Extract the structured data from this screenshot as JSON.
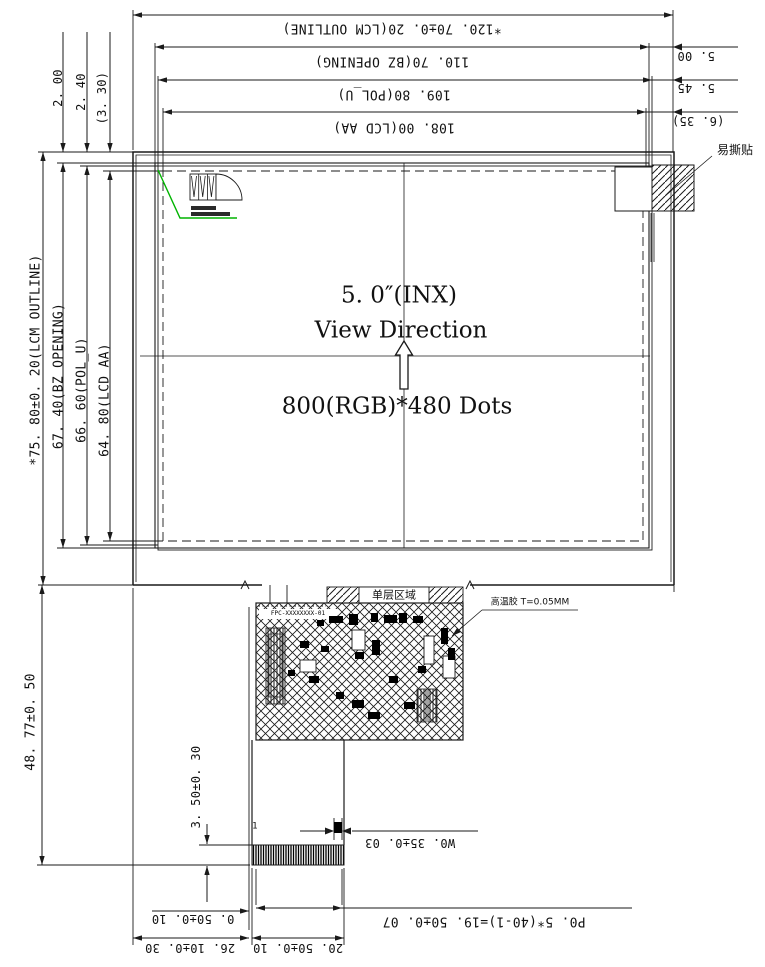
{
  "colors": {
    "line": "#1a1a1a",
    "polarizer_mark_line": "#00b400"
  },
  "dims_top": {
    "lcm": "*120. 70±0. 20(LCM OUTLINE)",
    "bz": "110. 70(BZ OPENING)",
    "pol": "109. 80(POL_U)",
    "aa": "108. 00(LCD AA)"
  },
  "dims_right": {
    "d1": "5. 00",
    "d2": "5. 45",
    "d3": "(6. 35)"
  },
  "dims_top_left": {
    "d1": "2. 00",
    "d2": "2. 40",
    "d3": "(3. 30)"
  },
  "dims_left": {
    "lcm": "*75. 80±0. 20(LCM OUTLINE)",
    "bz": "67. 40(BZ OPENING)",
    "pol": "66. 60(POL_U)",
    "aa": "64. 80(LCD AA)",
    "total_height": "48. 77±0. 50",
    "tail_height": "3. 50±0. 30"
  },
  "dims_bottom": {
    "pin_width": "W0. 35±0. 03",
    "pitch": "P0. 5*(40-1)=19. 50±0. 07",
    "edge_offset": "0. 50±0. 10",
    "connector_width": "20. 50±0. 10",
    "connector_offset": "26. 10±0. 30"
  },
  "panel": {
    "size": "5. 0″(INX)",
    "view": "View Direction",
    "resolution": "800(RGB)*480 Dots"
  },
  "labels": {
    "easy_tear_sticker": "易撕贴",
    "single_layer_area": "单层区域",
    "high_temp_adhesive": "高温胶 T=0.05MM",
    "pin1": "1",
    "fpc_marking": "FPC-XXXXXXXX-01"
  }
}
